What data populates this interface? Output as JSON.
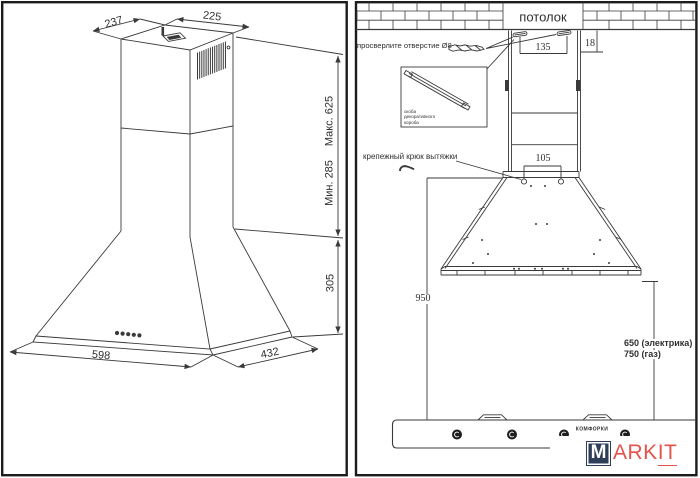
{
  "left_view": {
    "top_width": "237",
    "top_depth": "225",
    "height_max": "Макс. 625",
    "height_min": "Мин. 285",
    "canopy_height": "305",
    "base_width": "598",
    "base_depth": "432"
  },
  "right_view": {
    "ceiling": "потолок",
    "drill_note": "просверлите отверстие Ø8",
    "bracket_caption": {
      "line1": "скоба",
      "line2": "декоративного",
      "line3": "короба"
    },
    "hook_note": "крепежный крюк вытяжки",
    "bracket_spacing": "135",
    "ceiling_offset": "18",
    "hook_spacing": "105",
    "mount_height": "950",
    "clearance_electric": "650 (электрика)",
    "clearance_gas": "750 (газ)",
    "burners": "комфорки"
  },
  "logo": {
    "m": "M",
    "ark": "ARK",
    "it": "IT"
  },
  "colors": {
    "line": "#3a3a3a",
    "logo_box": "#2e3e59",
    "logo_text": "#e2534d"
  }
}
